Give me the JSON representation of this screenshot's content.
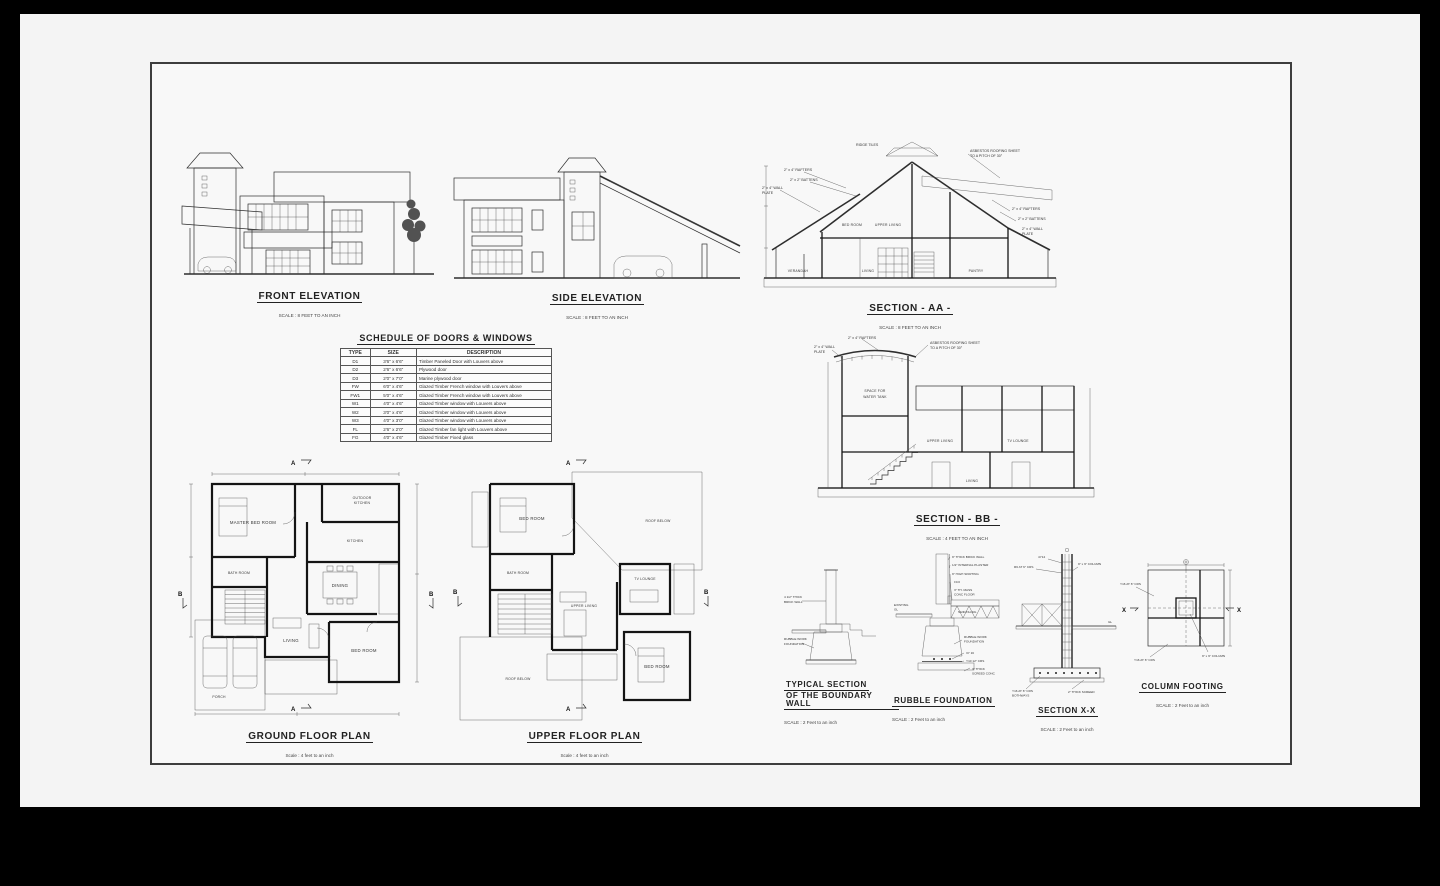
{
  "elevations": {
    "front": {
      "title": "FRONT ELEVATION",
      "scale": "SCALE : 8 FEET TO AN INCH"
    },
    "side": {
      "title": "SIDE ELEVATION",
      "scale": "SCALE : 8 FEET TO AN INCH"
    }
  },
  "schedule": {
    "title": "SCHEDULE OF DOORS & WINDOWS",
    "headers": [
      "TYPE",
      "SIZE",
      "DESCRIPTION"
    ],
    "rows": [
      [
        "D1",
        "3'6\" x 6'6\"",
        "Timber Paneled Door with Louvers above"
      ],
      [
        "D2",
        "2'6\" x 6'6\"",
        "Plywood door"
      ],
      [
        "D3",
        "2'0\" x 7'0\"",
        "Marine plywood door"
      ],
      [
        "FW",
        "6'0\" x 4'6\"",
        "Glazed Timber French window with Louvers above"
      ],
      [
        "FW1",
        "5'0\" x 4'6\"",
        "Glazed Timber French window with Louvers above"
      ],
      [
        "W1",
        "4'0\" x 4'6\"",
        "Glazed Timber window with Louvers above"
      ],
      [
        "W2",
        "3'0\" x 4'6\"",
        "Glazed Timber window with Louvers above"
      ],
      [
        "W3",
        "4'0\" x 3'0\"",
        "Glazed Timber window with Louvers above"
      ],
      [
        "FL",
        "2'6\" x 2'0\"",
        "Glazed Timber fan light with Louvers above"
      ],
      [
        "FG",
        "4'0\" x 4'6\"",
        "Glazed Timber Fixed glass"
      ]
    ]
  },
  "sections": {
    "aa": {
      "title": "SECTION - AA -",
      "scale": "SCALE : 8 FEET TO AN INCH",
      "labels": {
        "rafters": "2\" x 4\" RAFTERS",
        "battens": "2\" x 2\" BATTENS",
        "wall_plate_1": "2\" x 4\" WALL",
        "wall_plate_2": "PLATE",
        "ridge_tiles": "RIDGE TILES",
        "asbestos_1": "ASBESTOS ROOFING SHEET",
        "asbestos_2": "TO A PITCH OF 30°",
        "bed_room": "BED ROOM",
        "upper_living": "UPPER LIVING",
        "verandah": "VERANDAH",
        "living": "LIVING",
        "pantry": "PANTRY"
      }
    },
    "bb": {
      "title": "SECTION - BB -",
      "scale": "SCALE : 4 FEET TO AN INCH",
      "labels": {
        "rafters": "2\" x 4\" RAFTERS",
        "wall_plate_1": "2\" x 4\" WALL",
        "wall_plate_2": "PLATE",
        "asbestos_1": "ASBESTOS ROOFING SHEET",
        "asbestos_2": "TO A PITCH OF 30°",
        "water_tank_1": "SPACE FOR",
        "water_tank_2": "WATER TANK",
        "upper_living": "UPPER LIVING",
        "tv_lounge": "TV LOUNGE",
        "living": "LIVING"
      }
    }
  },
  "plans": {
    "ground": {
      "title": "GROUND FLOOR PLAN",
      "scale": "Scale : 4 feet to an inch",
      "rooms": {
        "master_bed": "MASTER BED ROOM",
        "bath": "BATH ROOM",
        "outdoor_kitchen_1": "OUTDOOR",
        "outdoor_kitchen_2": "KITCHEN",
        "kitchen": "KITCHEN",
        "dining": "DINING",
        "living": "LIVING",
        "bed": "BED ROOM",
        "porch": "PORCH"
      }
    },
    "upper": {
      "title": "UPPER FLOOR PLAN",
      "scale": "Scale : 4 feet to an inch",
      "rooms": {
        "bed1": "BED ROOM",
        "bath": "BATH ROOM",
        "upper_living": "UPPER LIVING",
        "tv_lounge": "TV LOUNGE",
        "bed2": "BED ROOM",
        "roof_below_1": "ROOF BELOW",
        "roof_below_2": "ROOF BELOW"
      }
    }
  },
  "details": {
    "boundary": {
      "title_1": "TYPICAL SECTION",
      "title_2": "OF THE BOUNDARY WALL",
      "scale": "SCALE : 2 Feet to an inch",
      "labels": {
        "brick_1": "4 1/2\" THICK",
        "brick_2": "BRICK WALL",
        "rubble_1": "RUBBLE WORK",
        "rubble_2": "FOUNDATION"
      }
    },
    "rubble": {
      "title": "RUBBLE FOUNDATION",
      "scale": "SCALE : 2 Feet to an inch",
      "labels": {
        "brick_wall": "9\" THICK BRICK WALL",
        "plaster": "1/2\" INTERNAL PLASTER",
        "skirting": "9\" HIGH SKIRTING",
        "level": "±0.0",
        "floor_1": "3\" TH. MASS",
        "floor_2": "CONC FLOOR",
        "existing_1": "EXISTING",
        "existing_2": "GL",
        "sand": "SAND FILLING",
        "rubble_1": "RUBBLE WORK",
        "rubble_2": "FOUNDATION",
        "bars": "3Y 16",
        "mesh": "Y10 12\" CRS",
        "screed_1": "3\" THICK",
        "screed_2": "SCREED CONC"
      }
    },
    "xx": {
      "title": "SECTION X-X",
      "scale": "SCALE : 2 Feet to an inch",
      "labels": {
        "bars": "4Y12",
        "stirrups": "R6 AT 6\" CRS",
        "column": "9\" x 9\" COLUMN",
        "gl": "GL",
        "mesh_1": "Y16 AT 6\" CRS",
        "mesh_2": "BOTHWAYS",
        "screed": "2\" THICK SCREED"
      }
    },
    "footing": {
      "title": "COLUMN FOOTING",
      "scale": "SCALE : 2 Feet to an inch",
      "labels": {
        "mesh_top": "Y16 AT 6\" CRS",
        "mesh_bottom": "Y16 AT 6\" CRS",
        "column": "9\" x 9\" COLUMN",
        "x": "X"
      }
    }
  },
  "markers": {
    "a": "A",
    "b": "B"
  }
}
